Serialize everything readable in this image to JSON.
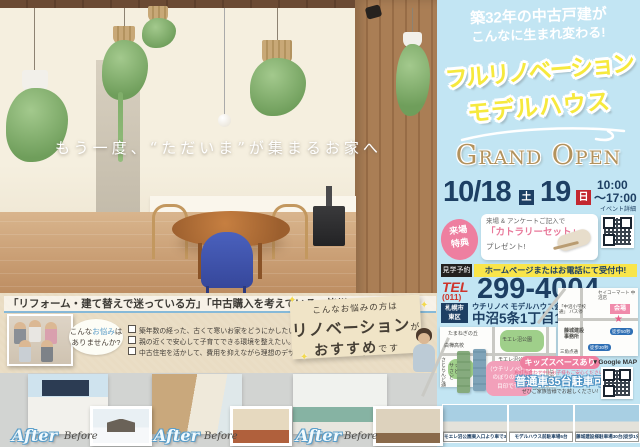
{
  "hero": {
    "tagline": "もう一度、“ただいま”が集まるお家へ"
  },
  "consult": {
    "header": "「リフォーム・建て替えで迷っている方」「中古購入を考えている」皆様へ",
    "bubble_pre": "こんな",
    "bubble_hl": "お悩み",
    "bubble_post": "は",
    "bubble_line2": "ありませんか?",
    "checklist": [
      "築年数の経った、古くて寒いお家をどうにかしたい。",
      "親の近くで安心して子育てできる環境を整えたい。",
      "中古住宅を活かして、費用を抑えながら理想のデザインと間取りにしたい。"
    ],
    "reco_line1": "こんなお悩みの方は",
    "reco_big1": "リノベーション",
    "reco_small1": "が",
    "reco_big2": "おすすめ",
    "reco_small2": "です"
  },
  "ba": {
    "after": "After",
    "before": "Before"
  },
  "right": {
    "catch1": "築32年の中古戸建が",
    "catch2": "こんなに生まれ変わる!",
    "title1": "フルリノベーション",
    "title2": "モデルハウス",
    "grand_open": "Grand Open",
    "date_md": "10/18",
    "day1": "土",
    "date_19": "19",
    "day2": "日",
    "time_from": "10:00",
    "time_to": "〜17:00",
    "event_qr": "イベント詳細",
    "tokuten1": "来場",
    "tokuten2": "特典",
    "gift_line1": "来場 & アンケートご記入で",
    "gift_line2": "「カトラリーセット」",
    "gift_line3": "プレゼント!",
    "reserve_badge": "見学予約",
    "reserve_text": "ホームページまたはお電話にて受付中!",
    "tel_label": "TEL",
    "tel_area": "(011)",
    "tel_number": "299-4004",
    "addr_badge1": "札幌市",
    "addr_badge2": "東区",
    "venue": "ウチリノベ モデルハウス会場",
    "street": "中沼5条1丁目1-20",
    "map": {
      "onion": "たまねぎの丘",
      "school": "白樺高校",
      "satoland": "サッポロ さとらんど",
      "park": "モエレ沼公園",
      "park_east": "モエレ沼公園 東入口",
      "road_left": "さとらんど通",
      "road_right": "モエレ沼通"
    },
    "minimap": {
      "seicomart": "セイコーマート 中沼店",
      "busstop": "「中沼小学校通」 バス停",
      "kaijo": "会場",
      "fujishiro": "藤城建設 事務所",
      "walk1": "徒歩50秒",
      "walk2": "徒歩30秒",
      "road": "三角点通",
      "gmap": "▼Google MAP"
    },
    "flag_note1": "（ウチリノベ）の",
    "flag_note2": "のぼりの旗が",
    "flag_note3": "目印です!",
    "kids_bar": "キッズスペースあり",
    "kids_note": "お打ち合わせ中もお子様もご安心ください♪",
    "parking": "普通車35台駐車可",
    "invite": "ぜひご家族皆様でお越しください!",
    "captions": [
      "モエレ沼公園東入口より車で3分",
      "モデルハウス前駐車場5台",
      "藤城建設様駐車場30台(徒歩1分)"
    ]
  },
  "colors": {
    "panel_blue": "#c2e5f3",
    "title_yellow": "#f6e93d",
    "navy": "#1d3f63",
    "red": "#c3272f",
    "pink": "#ee7fa0",
    "gold": "#b3925c",
    "kraft": "#e9dcc3"
  }
}
